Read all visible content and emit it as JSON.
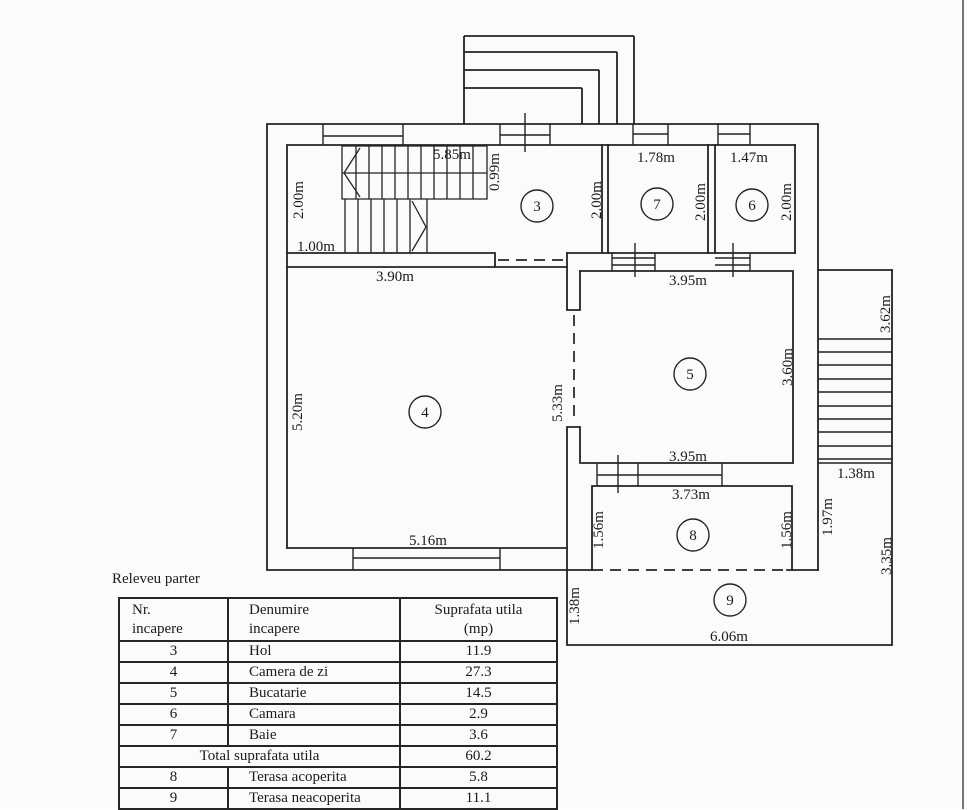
{
  "floor_plan": {
    "rooms": [
      {
        "number": "3",
        "cx": 537,
        "cy": 206
      },
      {
        "number": "7",
        "cx": 657,
        "cy": 204
      },
      {
        "number": "6",
        "cx": 752,
        "cy": 205
      },
      {
        "number": "4",
        "cx": 425,
        "cy": 412
      },
      {
        "number": "5",
        "cx": 690,
        "cy": 374
      },
      {
        "number": "8",
        "cx": 693,
        "cy": 535
      },
      {
        "number": "9",
        "cx": 730,
        "cy": 600
      }
    ],
    "dimensions": [
      {
        "text": "5.85m",
        "x": 452,
        "y": 159,
        "rot": 0
      },
      {
        "text": "0.99m",
        "x": 499,
        "y": 172,
        "rot": -90
      },
      {
        "text": "2.00m",
        "x": 303,
        "y": 200,
        "rot": -90
      },
      {
        "text": "1.00m",
        "x": 316,
        "y": 251,
        "rot": 0
      },
      {
        "text": "2.00m",
        "x": 601,
        "y": 200,
        "rot": -90
      },
      {
        "text": "1.78m",
        "x": 656,
        "y": 162,
        "rot": 0
      },
      {
        "text": "2.00m",
        "x": 705,
        "y": 202,
        "rot": -90
      },
      {
        "text": "1.47m",
        "x": 749,
        "y": 162,
        "rot": 0
      },
      {
        "text": "2.00m",
        "x": 791,
        "y": 202,
        "rot": -90
      },
      {
        "text": "3.90m",
        "x": 395,
        "y": 281,
        "rot": 0
      },
      {
        "text": "3.95m",
        "x": 688,
        "y": 285,
        "rot": 0
      },
      {
        "text": "3.62m",
        "x": 890,
        "y": 314,
        "rot": -90
      },
      {
        "text": "5.20m",
        "x": 302,
        "y": 412,
        "rot": -90
      },
      {
        "text": "5.33m",
        "x": 562,
        "y": 403,
        "rot": -90
      },
      {
        "text": "3.60m",
        "x": 792,
        "y": 367,
        "rot": -90
      },
      {
        "text": "3.95m",
        "x": 688,
        "y": 461,
        "rot": 0
      },
      {
        "text": "1.38m",
        "x": 856,
        "y": 478,
        "rot": 0
      },
      {
        "text": "3.73m",
        "x": 691,
        "y": 499,
        "rot": 0
      },
      {
        "text": "1.56m",
        "x": 603,
        "y": 530,
        "rot": -90
      },
      {
        "text": "1.56m",
        "x": 791,
        "y": 530,
        "rot": -90
      },
      {
        "text": "1.97m",
        "x": 832,
        "y": 517,
        "rot": -90
      },
      {
        "text": "5.16m",
        "x": 428,
        "y": 545,
        "rot": 0
      },
      {
        "text": "3.35m",
        "x": 891,
        "y": 556,
        "rot": -90
      },
      {
        "text": "1.38m",
        "x": 579,
        "y": 606,
        "rot": -90
      },
      {
        "text": "6.06m",
        "x": 729,
        "y": 641,
        "rot": 0
      }
    ]
  },
  "table": {
    "caption": "Releveu parter",
    "headers": {
      "col1_line1": "Nr.",
      "col1_line2": "incapere",
      "col2_line1": "Denumire",
      "col2_line2": "incapere",
      "col3_line1": "Suprafata utila",
      "col3_line2": "(mp)"
    },
    "rows": [
      {
        "nr": "3",
        "name": "Hol",
        "area": "11.9"
      },
      {
        "nr": "4",
        "name": "Camera de zi",
        "area": "27.3"
      },
      {
        "nr": "5",
        "name": "Bucatarie",
        "area": "14.5"
      },
      {
        "nr": "6",
        "name": "Camara",
        "area": "2.9"
      },
      {
        "nr": "7",
        "name": "Baie",
        "area": "3.6"
      }
    ],
    "total_row": {
      "label": "Total suprafata utila",
      "area": "60.2"
    },
    "terrace_rows": [
      {
        "nr": "8",
        "name": "Terasa acoperita",
        "area": "5.8"
      },
      {
        "nr": "9",
        "name": "Terasa neacoperita",
        "area": "11.1"
      }
    ]
  }
}
